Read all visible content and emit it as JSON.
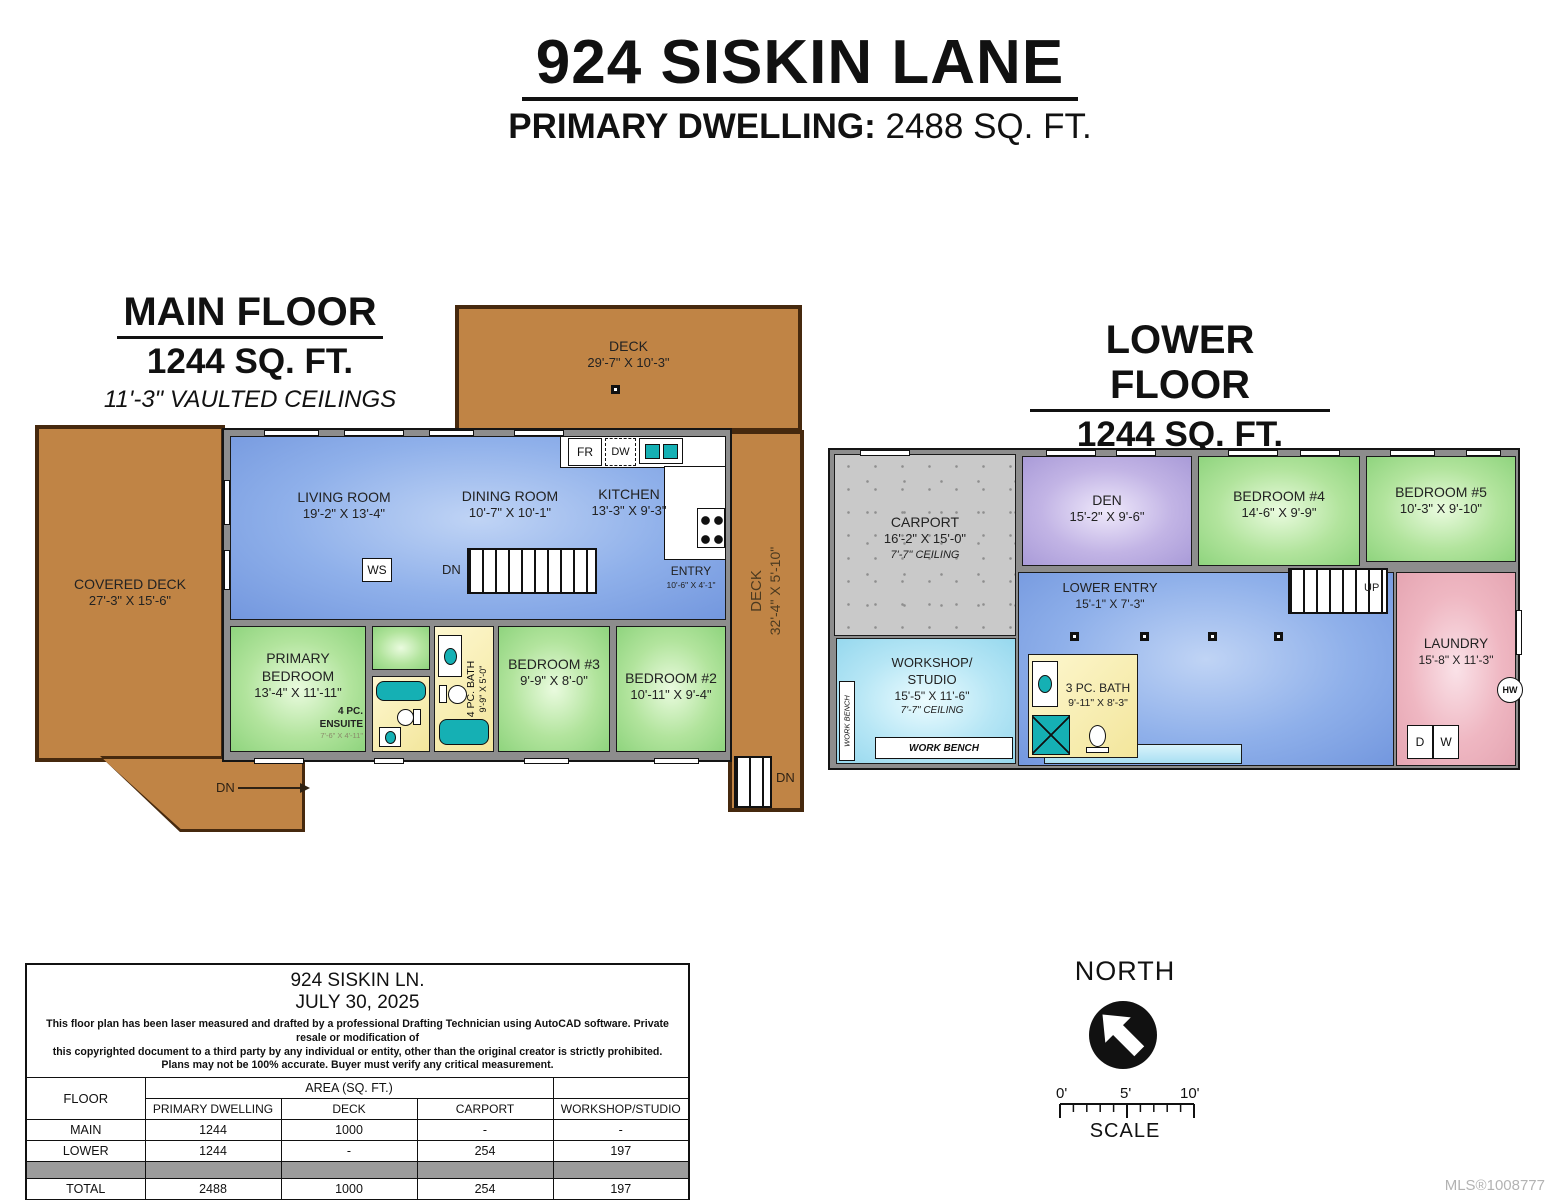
{
  "header": {
    "title": "924 SISKIN LANE",
    "subtitle_label": "PRIMARY DWELLING:",
    "subtitle_value": "2488 SQ. FT."
  },
  "main_floor": {
    "heading": "MAIN FLOOR",
    "area": "1244 SQ. FT.",
    "ceiling": "11'-3\" VAULTED CEILINGS",
    "deck_top": {
      "name": "DECK",
      "dims": "29'-7\" X 10'-3\""
    },
    "covered_deck": {
      "name": "COVERED DECK",
      "dims": "27'-3\" X 15'-6\""
    },
    "deck_right": {
      "name": "DECK",
      "dims": "32'-4\" X 5'-10\""
    },
    "living": {
      "name": "LIVING ROOM",
      "dims": "19'-2\" X 13'-4\""
    },
    "dining": {
      "name": "DINING ROOM",
      "dims": "10'-7\" X 10'-1\""
    },
    "kitchen": {
      "name": "KITCHEN",
      "dims": "13'-3\" X 9'-3\""
    },
    "entry": {
      "name": "ENTRY",
      "dims": "10'-6\" X 4'-1\""
    },
    "primary_bedroom": {
      "name1": "PRIMARY",
      "name2": "BEDROOM",
      "dims": "13'-4\" X 11'-11\""
    },
    "ensuite": {
      "name1": "4 PC.",
      "name2": "ENSUITE",
      "dims": "7'-6\" X 4'-11\""
    },
    "bath": {
      "name": "4 PC. BATH",
      "dims": "9'-9\" X 5'-0\""
    },
    "bedroom3": {
      "name": "BEDROOM #3",
      "dims": "9'-9\" X 8'-0\""
    },
    "bedroom2": {
      "name": "BEDROOM #2",
      "dims": "10'-11\" X 9'-4\""
    },
    "fr": "FR",
    "dw": "DW",
    "ws": "WS",
    "dn": "DN"
  },
  "lower_floor": {
    "heading": "LOWER FLOOR",
    "area": "1244 SQ. FT.",
    "ceiling": "7'-8\" CEILINGS",
    "carport": {
      "name": "CARPORT",
      "dims": "16'-2\" X 15'-0\"",
      "ceiling": "7'-7\" CEILING"
    },
    "den": {
      "name": "DEN",
      "dims": "15'-2\" X 9'-6\""
    },
    "bedroom4": {
      "name": "BEDROOM #4",
      "dims": "14'-6\" X 9'-9\""
    },
    "bedroom5": {
      "name": "BEDROOM #5",
      "dims": "10'-3\" X 9'-10\""
    },
    "lower_entry": {
      "name": "LOWER ENTRY",
      "dims": "15'-1\" X 7'-3\""
    },
    "workshop": {
      "name1": "WORKSHOP/",
      "name2": "STUDIO",
      "dims": "15'-5\" X 11'-6\"",
      "ceiling": "7'-7\" CEILING"
    },
    "bath": {
      "name": "3 PC. BATH",
      "dims": "9'-11\" X 8'-3\""
    },
    "laundry": {
      "name": "LAUNDRY",
      "dims": "15'-8\" X 11'-3\""
    },
    "up": "UP",
    "hw": "HW",
    "dryer": "D",
    "washer": "W",
    "work_bench": "WORK BENCH"
  },
  "info_table": {
    "address": "924 SISKIN LN.",
    "date": "JULY 30, 2025",
    "disclaimer1": "This floor plan has been laser measured and drafted by a professional Drafting Technician using AutoCAD software. Private resale or modification of",
    "disclaimer2": "this copyrighted document to a third party by any individual or entity, other than the original creator is strictly prohibited.",
    "disclaimer3": "Plans may not be 100% accurate.  Buyer must verify any critical measurement.",
    "floor_header": "FLOOR",
    "area_header": "AREA (SQ. FT.)",
    "col1": "PRIMARY DWELLING",
    "col2": "DECK",
    "col3": "CARPORT",
    "col4": "WORKSHOP/STUDIO",
    "rows": [
      {
        "floor": "MAIN",
        "v1": "1244",
        "v2": "1000",
        "v3": "-",
        "v4": "-"
      },
      {
        "floor": "LOWER",
        "v1": "1244",
        "v2": "-",
        "v3": "254",
        "v4": "197"
      }
    ],
    "total": {
      "floor": "TOTAL",
      "v1": "2488",
      "v2": "1000",
      "v3": "254",
      "v4": "197"
    }
  },
  "compass": {
    "north": "NORTH",
    "scale": "SCALE",
    "tick0": "0'",
    "tick5": "5'",
    "tick10": "10'"
  },
  "footer": {
    "mls": "MLS®1008777"
  }
}
